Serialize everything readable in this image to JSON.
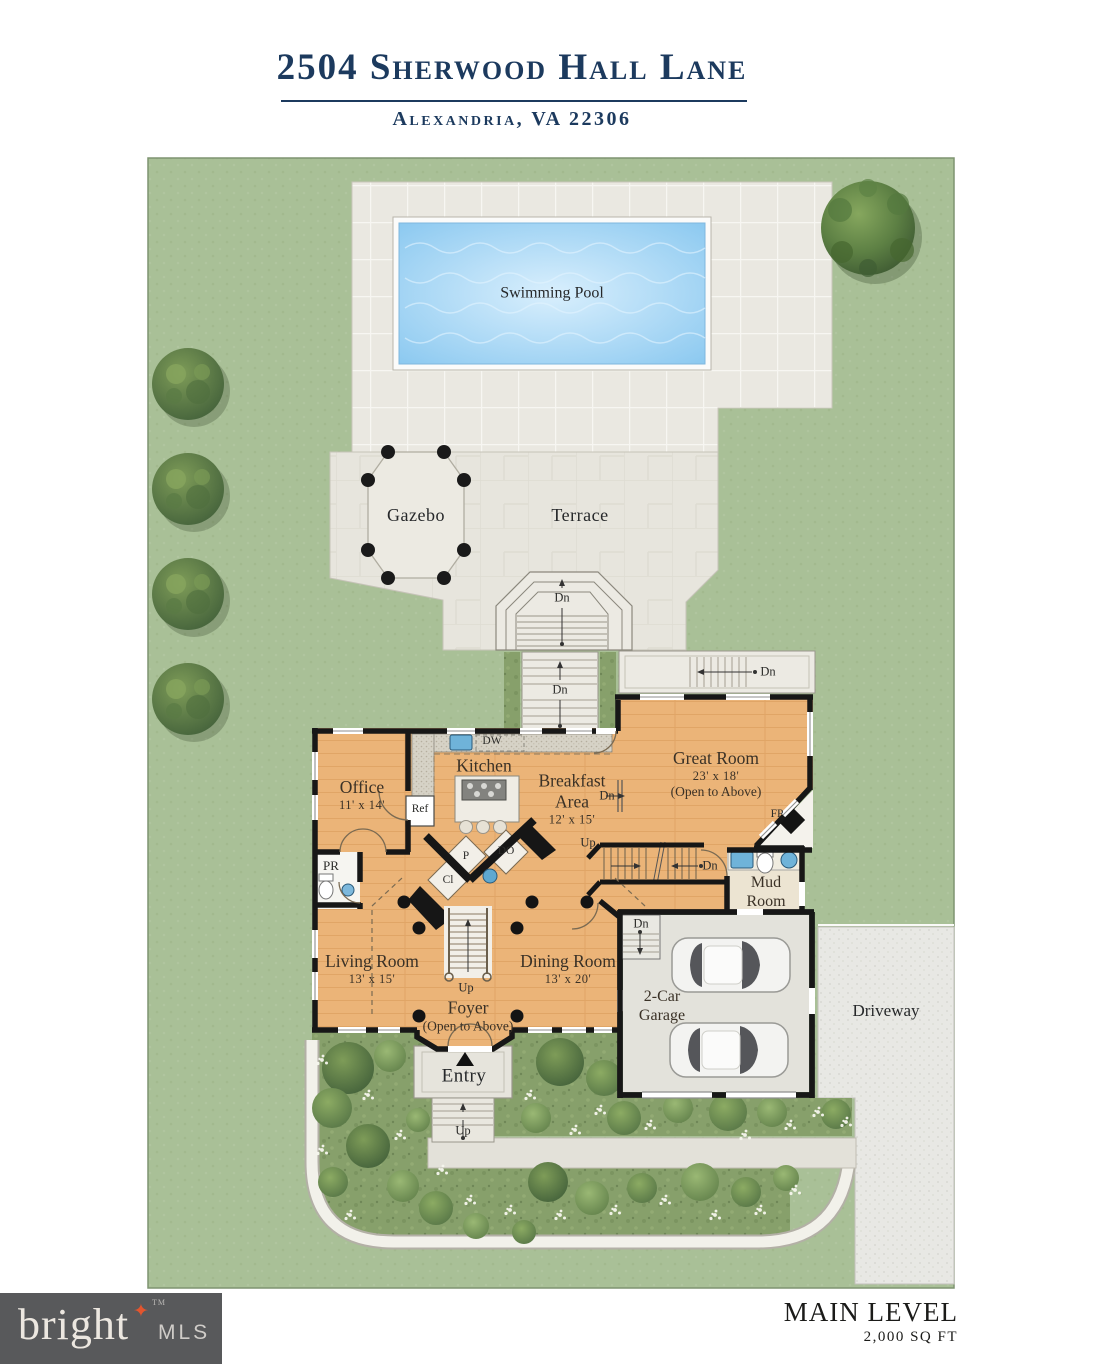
{
  "header": {
    "title": "2504 Sherwood Hall Lane",
    "subtitle": "Alexandria, VA 22306"
  },
  "site": {
    "swimming_pool": "Swimming Pool",
    "gazebo": "Gazebo",
    "terrace": "Terrace",
    "driveway": "Driveway",
    "entry": "Entry"
  },
  "rooms": [
    {
      "name": "Office",
      "dims": "11' x 14'"
    },
    {
      "name": "Kitchen"
    },
    {
      "name": "Breakfast Area",
      "dims": "12' x 15'"
    },
    {
      "name": "Great Room",
      "dims": "23' x 18'",
      "note": "(Open to Above)"
    },
    {
      "name": "Mud Room"
    },
    {
      "name": "Living Room",
      "dims": "13' x 15'"
    },
    {
      "name": "Dining Room",
      "dims": "13' x 20'"
    },
    {
      "name": "Foyer",
      "note": "(Open to Above)"
    },
    {
      "name": "2-Car Garage"
    }
  ],
  "annotations": {
    "dn": "Dn",
    "up": "Up",
    "pr": "PR",
    "ref": "Ref",
    "dw": "DW",
    "fp": "FP",
    "p": "P",
    "do": "DO",
    "cl": "Cl"
  },
  "footer": {
    "level": "MAIN LEVEL",
    "area": "2,000 SQ FT",
    "brand": "bright",
    "brand_tm": "TM",
    "brand_suffix": "MLS"
  },
  "colors": {
    "header_navy": "#1c3a5e",
    "lawn_green": "#a9c097",
    "floor_wood": "#ebb478",
    "pool_blue": "#8ecdf2",
    "paving": "#eae8e1",
    "garden_green": "#87a06b",
    "logo_bg": "#58595b",
    "logo_star": "#e2552e"
  }
}
